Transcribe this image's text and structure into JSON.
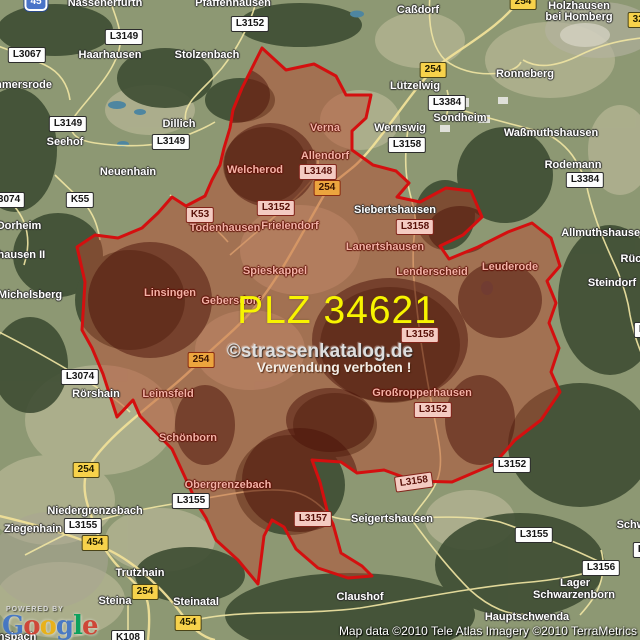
{
  "map": {
    "plz_label": "PLZ 34621",
    "watermark_line1": "©strassenkatalog.de",
    "watermark_line2": "Verwendung verboten !",
    "attribution": "Map data ©2010 Tele Atlas  Imagery ©2010 TerraMetrics",
    "powered_by": "POWERED BY",
    "google_logo_letters": [
      {
        "ch": "G",
        "color": "#4175c8"
      },
      {
        "ch": "o",
        "color": "#d23f31"
      },
      {
        "ch": "o",
        "color": "#eeb211"
      },
      {
        "ch": "g",
        "color": "#4175c8"
      },
      {
        "ch": "l",
        "color": "#00a05a"
      },
      {
        "ch": "e",
        "color": "#d23f31"
      }
    ],
    "colors": {
      "region_fill": "rgba(186,72,45,0.48)",
      "region_border": "#d40f0f",
      "field_green": "#a3af88",
      "forest_green": "#3e4d33",
      "beige_field": "#c6c2a2",
      "road_yellow": "#efe4a2",
      "water_blue": "#4e86a0",
      "plz_yellow": "#f8f400"
    },
    "towns_outside": [
      {
        "name": "Nassenerfurth",
        "x": 105,
        "y": 3
      },
      {
        "name": "Pfaffenhausen",
        "x": 233,
        "y": 3
      },
      {
        "name": "Caßdorf",
        "x": 418,
        "y": 10
      },
      {
        "name": "Holzhausen",
        "x": 579,
        "y": 6
      },
      {
        "name": "bei Homberg",
        "x": 579,
        "y": 17
      },
      {
        "name": "Haarhausen",
        "x": 110,
        "y": 55
      },
      {
        "name": "Stolzenbach",
        "x": 207,
        "y": 55
      },
      {
        "name": "mmersrode",
        "x": 22,
        "y": 85
      },
      {
        "name": "Ronneberg",
        "x": 525,
        "y": 74
      },
      {
        "name": "Lützelwig",
        "x": 415,
        "y": 86
      },
      {
        "name": "Sondheim",
        "x": 460,
        "y": 118
      },
      {
        "name": "Dillich",
        "x": 179,
        "y": 124
      },
      {
        "name": "Wernswig",
        "x": 400,
        "y": 128
      },
      {
        "name": "Waßmuthshausen",
        "x": 551,
        "y": 133
      },
      {
        "name": "Seehof",
        "x": 65,
        "y": 142
      },
      {
        "name": "Rodemann",
        "x": 573,
        "y": 165
      },
      {
        "name": "Neuenhain",
        "x": 128,
        "y": 172
      },
      {
        "name": "Siebertshausen",
        "x": 395,
        "y": 210
      },
      {
        "name": "Dorheim",
        "x": 19,
        "y": 226
      },
      {
        "name": "Allmuthshausen",
        "x": 604,
        "y": 233
      },
      {
        "name": "nhausen II",
        "x": 18,
        "y": 255
      },
      {
        "name": "Rück",
        "x": 634,
        "y": 259
      },
      {
        "name": "Steindorf",
        "x": 612,
        "y": 283
      },
      {
        "name": "Michelsberg",
        "x": 30,
        "y": 295
      },
      {
        "name": "Rörshain",
        "x": 96,
        "y": 394
      },
      {
        "name": "Niedergrenzebach",
        "x": 95,
        "y": 511
      },
      {
        "name": "Seigertshausen",
        "x": 392,
        "y": 519
      },
      {
        "name": "Schwa",
        "x": 634,
        "y": 525
      },
      {
        "name": "Ziegenhain",
        "x": 33,
        "y": 529
      },
      {
        "name": "Trutzhain",
        "x": 140,
        "y": 573
      },
      {
        "name": "Lager",
        "x": 575,
        "y": 583
      },
      {
        "name": "Schwarzenborn",
        "x": 574,
        "y": 595
      },
      {
        "name": "Claushof",
        "x": 360,
        "y": 597
      },
      {
        "name": "Steina",
        "x": 115,
        "y": 601
      },
      {
        "name": "Steinatal",
        "x": 196,
        "y": 602
      },
      {
        "name": "Hauptschwenda",
        "x": 527,
        "y": 617
      },
      {
        "name": "ansbach",
        "x": 14,
        "y": 637
      }
    ],
    "towns_inside": [
      {
        "name": "Verna",
        "x": 325,
        "y": 128
      },
      {
        "name": "Allendorf",
        "x": 325,
        "y": 156
      },
      {
        "name": "Welcherod",
        "x": 255,
        "y": 170
      },
      {
        "name": "Todenhausen",
        "x": 225,
        "y": 228
      },
      {
        "name": "Frielendorf",
        "x": 290,
        "y": 226
      },
      {
        "name": "Lanertshausen",
        "x": 385,
        "y": 247
      },
      {
        "name": "Leuderode",
        "x": 510,
        "y": 267
      },
      {
        "name": "Spieskappel",
        "x": 275,
        "y": 271
      },
      {
        "name": "Lenderscheid",
        "x": 432,
        "y": 272
      },
      {
        "name": "Linsingen",
        "x": 170,
        "y": 293
      },
      {
        "name": "Gebersdorf",
        "x": 231,
        "y": 301
      },
      {
        "name": "Großropperhausen",
        "x": 422,
        "y": 393
      },
      {
        "name": "Leimsfeld",
        "x": 168,
        "y": 394
      },
      {
        "name": "Schönborn",
        "x": 188,
        "y": 438
      },
      {
        "name": "Obergrenzebach",
        "x": 228,
        "y": 485
      }
    ],
    "road_badges": [
      {
        "label": "45",
        "type": "motorway",
        "x": 36,
        "y": 2
      },
      {
        "label": "254",
        "type": "bundes",
        "x": 523,
        "y": 2
      },
      {
        "label": "323",
        "type": "bundes",
        "x": 641,
        "y": 20
      },
      {
        "label": "L3152",
        "type": "land",
        "x": 250,
        "y": 24
      },
      {
        "label": "L3149",
        "type": "land",
        "x": 124,
        "y": 37
      },
      {
        "label": "L3067",
        "type": "land",
        "x": 27,
        "y": 55
      },
      {
        "label": "254",
        "type": "bundes",
        "x": 433,
        "y": 70
      },
      {
        "label": "L3384",
        "type": "land",
        "x": 447,
        "y": 103
      },
      {
        "label": "L3149",
        "type": "land",
        "x": 68,
        "y": 124
      },
      {
        "label": "L3149",
        "type": "land",
        "x": 171,
        "y": 142
      },
      {
        "label": "L3158",
        "type": "land",
        "x": 407,
        "y": 145
      },
      {
        "label": "L3148",
        "type": "land_in",
        "x": 318,
        "y": 172
      },
      {
        "label": "L3384",
        "type": "land",
        "x": 585,
        "y": 180
      },
      {
        "label": "254",
        "type": "bundes_in",
        "x": 327,
        "y": 188
      },
      {
        "label": "L3074",
        "type": "land",
        "x": 6,
        "y": 200
      },
      {
        "label": "K55",
        "type": "kreis",
        "x": 80,
        "y": 200
      },
      {
        "label": "L3152",
        "type": "land_in",
        "x": 276,
        "y": 208
      },
      {
        "label": "K53",
        "type": "kreis_in",
        "x": 200,
        "y": 215
      },
      {
        "label": "L3158",
        "type": "land_in",
        "x": 415,
        "y": 227
      },
      {
        "label": "L3158",
        "type": "land_in",
        "x": 420,
        "y": 335
      },
      {
        "label": "L3155",
        "type": "land",
        "x": 653,
        "y": 330
      },
      {
        "label": "254",
        "type": "bundes_in",
        "x": 201,
        "y": 360
      },
      {
        "label": "L3074",
        "type": "land",
        "x": 80,
        "y": 377
      },
      {
        "label": "L3152",
        "type": "land_in",
        "x": 433,
        "y": 410
      },
      {
        "label": "L3152",
        "type": "land",
        "x": 512,
        "y": 465
      },
      {
        "label": "254",
        "type": "bundes",
        "x": 86,
        "y": 470
      },
      {
        "label": "L3158",
        "type": "land_in",
        "x": 414,
        "y": 482,
        "rot": -8
      },
      {
        "label": "L3155",
        "type": "land",
        "x": 191,
        "y": 501
      },
      {
        "label": "L3157",
        "type": "land_in",
        "x": 313,
        "y": 519
      },
      {
        "label": "L3155",
        "type": "land",
        "x": 83,
        "y": 526
      },
      {
        "label": "L3155",
        "type": "land",
        "x": 534,
        "y": 535
      },
      {
        "label": "454",
        "type": "bundes",
        "x": 95,
        "y": 543
      },
      {
        "label": "L3157",
        "type": "land",
        "x": 652,
        "y": 550
      },
      {
        "label": "L3156",
        "type": "land",
        "x": 601,
        "y": 568
      },
      {
        "label": "254",
        "type": "bundes",
        "x": 145,
        "y": 592
      },
      {
        "label": "454",
        "type": "bundes",
        "x": 188,
        "y": 623
      },
      {
        "label": "K108",
        "type": "kreis",
        "x": 128,
        "y": 638
      }
    ]
  }
}
